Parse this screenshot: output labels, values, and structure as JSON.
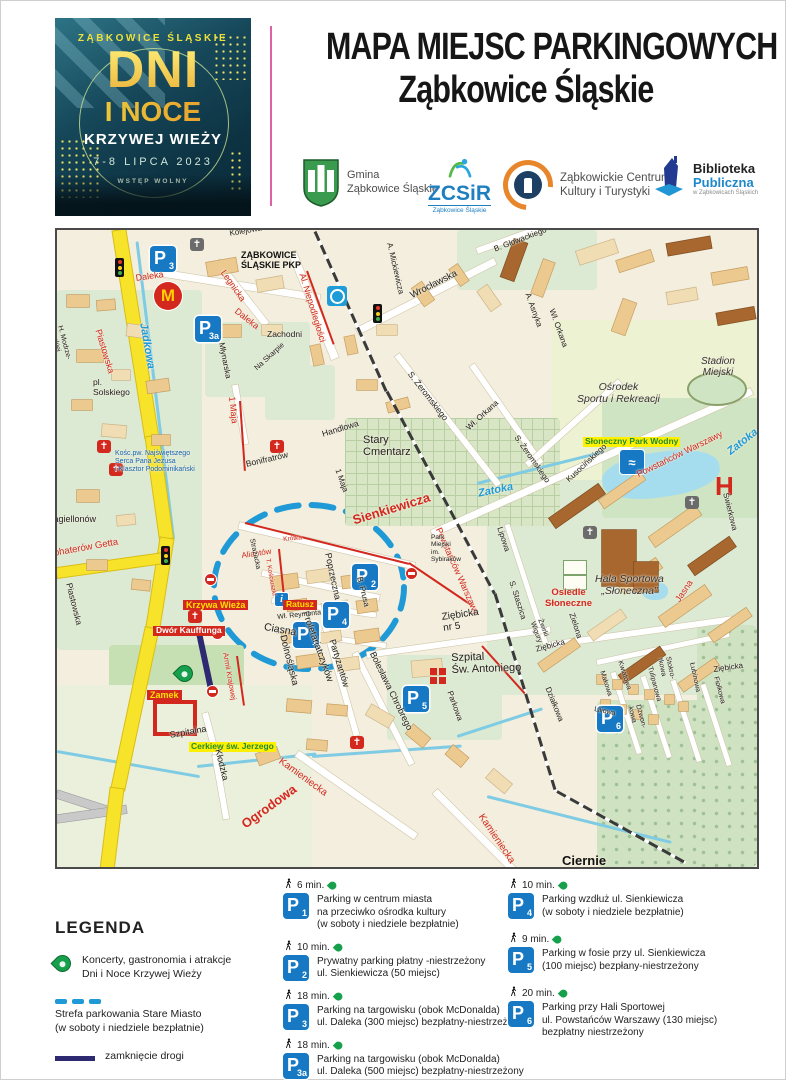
{
  "poster": {
    "city": "ZĄBKOWICE ŚLĄSKIE",
    "line1": "DNI",
    "line2": "I NOCE",
    "line3": "KRZYWEJ WIEŻY",
    "date": "7-8 LIPCA 2023",
    "admission": "WSTĘP WOLNY"
  },
  "header": {
    "title_line1": "MAPA MIEJSC PARKINGOWYCH",
    "title_line2": "Ząbkowice Śląskie"
  },
  "logos": {
    "gmina": "Gmina\nZąbkowice Śląskie",
    "zcsir_acronym": "ZCSiR",
    "zcsir_sub": "Ząbkowice Śląskie",
    "zckit": "Ząbkowickie Centrum\nKultury i Turystyki",
    "biblioteka_line1": "Biblioteka",
    "biblioteka_line2": "Publiczna",
    "biblioteka_sub": "w Ząbkowicach Śląskich"
  },
  "map": {
    "labels": [
      {
        "t": "Kolejowa",
        "x": 172,
        "y": 0,
        "r": -10,
        "s": 8,
        "c": "black"
      },
      {
        "t": "ZĄBKOWICE\nŚLĄSKIE PKP",
        "x": 184,
        "y": 20,
        "r": 0,
        "s": 9,
        "c": "blackb"
      },
      {
        "t": "Legnicka",
        "x": 170,
        "y": 38,
        "r": 55,
        "s": 9,
        "c": "red"
      },
      {
        "t": "Daleka",
        "x": 78,
        "y": 43,
        "r": -8,
        "s": 9,
        "c": "red"
      },
      {
        "t": "Daleka",
        "x": 182,
        "y": 76,
        "r": 38,
        "s": 9,
        "c": "red"
      },
      {
        "t": "Jadkowa",
        "x": 92,
        "y": 92,
        "r": 80,
        "s": 11,
        "c": "blue"
      },
      {
        "t": "Piastowska",
        "x": 46,
        "y": 98,
        "r": 73,
        "s": 9,
        "c": "red"
      },
      {
        "t": "H. Modrze-\njewskiej",
        "x": 6,
        "y": 95,
        "r": 75,
        "s": 7,
        "c": "black"
      },
      {
        "t": "pl.\nSolskiego",
        "x": 36,
        "y": 148,
        "r": 0,
        "s": 8.5,
        "c": "black"
      },
      {
        "t": "Młynarska",
        "x": 168,
        "y": 112,
        "r": 79,
        "s": 8,
        "c": "black"
      },
      {
        "t": "Na Skarpie",
        "x": 196,
        "y": 136,
        "r": -42,
        "s": 7.5,
        "c": "black"
      },
      {
        "t": "Zachodni",
        "x": 210,
        "y": 100,
        "r": 0,
        "s": 8.5,
        "c": "black"
      },
      {
        "t": "Al. Niepodległości",
        "x": 250,
        "y": 42,
        "r": 73,
        "s": 9,
        "c": "red"
      },
      {
        "t": "A. Mickiewicza",
        "x": 336,
        "y": 12,
        "r": 77,
        "s": 8,
        "c": "black"
      },
      {
        "t": "Wrocławska",
        "x": 352,
        "y": 62,
        "r": -27,
        "s": 9.5,
        "c": "black"
      },
      {
        "t": "B. Głowackiego",
        "x": 436,
        "y": 16,
        "r": -21,
        "s": 8,
        "c": "black"
      },
      {
        "t": "S. Żeromskiego",
        "x": 356,
        "y": 140,
        "r": 52,
        "s": 8.5,
        "c": "black"
      },
      {
        "t": "Wł. Orkana",
        "x": 408,
        "y": 196,
        "r": -42,
        "s": 8,
        "c": "black"
      },
      {
        "t": "S. Żeromskiego",
        "x": 462,
        "y": 204,
        "r": 55,
        "s": 8,
        "c": "black"
      },
      {
        "t": "A. Asnyka",
        "x": 474,
        "y": 62,
        "r": 70,
        "s": 8,
        "c": "black"
      },
      {
        "t": "Wł. Orkana",
        "x": 498,
        "y": 78,
        "r": 70,
        "s": 8,
        "c": "black"
      },
      {
        "t": "Stadion\nMiejski",
        "x": 644,
        "y": 126,
        "r": 0,
        "s": 10,
        "c": "it"
      },
      {
        "t": "Ośrodek\nSportu i Rekreacji",
        "x": 520,
        "y": 152,
        "r": 0,
        "s": 10.5,
        "c": "it"
      },
      {
        "t": "Słoneczny Park Wodny",
        "x": 526,
        "y": 207,
        "r": 0,
        "s": 8.5,
        "c": "hl"
      },
      {
        "t": "Zatoka",
        "x": 420,
        "y": 258,
        "r": -12,
        "s": 11,
        "c": "blue"
      },
      {
        "t": "Zatoka",
        "x": 668,
        "y": 218,
        "r": -38,
        "s": 11,
        "c": "blue"
      },
      {
        "t": "Powstańców Warszawy",
        "x": 578,
        "y": 240,
        "r": -26,
        "s": 9,
        "c": "red"
      },
      {
        "t": "Powstańców Warszawy",
        "x": 386,
        "y": 296,
        "r": 66,
        "s": 9,
        "c": "red"
      },
      {
        "t": "Kusocińskiego",
        "x": 508,
        "y": 248,
        "r": -43,
        "s": 8,
        "c": "black"
      },
      {
        "t": "Lipowa",
        "x": 446,
        "y": 296,
        "r": 72,
        "s": 8,
        "c": "black"
      },
      {
        "t": "S. Staszica",
        "x": 458,
        "y": 350,
        "r": 72,
        "s": 8,
        "c": "black"
      },
      {
        "t": "Świerkowa",
        "x": 672,
        "y": 262,
        "r": 76,
        "s": 8,
        "c": "black"
      },
      {
        "t": "Hala Sportowa\n„Słoneczna”",
        "x": 538,
        "y": 344,
        "r": 0,
        "s": 10.5,
        "c": "it"
      },
      {
        "t": "Osiedle\nSłoneczne",
        "x": 488,
        "y": 358,
        "r": 0,
        "s": 9.5,
        "c": "redbold"
      },
      {
        "t": "Jasna",
        "x": 616,
        "y": 368,
        "r": -56,
        "s": 9,
        "c": "red"
      },
      {
        "t": "Zielona",
        "x": 518,
        "y": 382,
        "r": 72,
        "s": 8,
        "c": "black"
      },
      {
        "t": "Żwirki\nWigury",
        "x": 486,
        "y": 388,
        "r": 70,
        "s": 7,
        "c": "black"
      },
      {
        "t": "Ziębicka",
        "x": 478,
        "y": 416,
        "r": -15,
        "s": 8,
        "c": "black"
      },
      {
        "t": "Ziębicka",
        "x": 656,
        "y": 436,
        "r": -8,
        "s": 8,
        "c": "black"
      },
      {
        "t": "Ziębicka\nnr 5",
        "x": 384,
        "y": 382,
        "r": -8,
        "s": 10,
        "c": "black"
      },
      {
        "t": "Szpital\nŚw. Antoniego",
        "x": 394,
        "y": 422,
        "r": -2,
        "s": 11,
        "c": "black"
      },
      {
        "t": "Parkowa",
        "x": 396,
        "y": 460,
        "r": 70,
        "s": 8,
        "c": "black"
      },
      {
        "t": "Bolesława Chrobrego",
        "x": 320,
        "y": 420,
        "r": 64,
        "s": 9,
        "c": "black"
      },
      {
        "t": "Działkowa",
        "x": 494,
        "y": 456,
        "r": 68,
        "s": 8,
        "c": "black"
      },
      {
        "t": "Partyzantów",
        "x": 280,
        "y": 408,
        "r": 73,
        "s": 9,
        "c": "black"
      },
      {
        "t": "B. Prusa",
        "x": 306,
        "y": 346,
        "r": 76,
        "s": 8,
        "c": "black"
      },
      {
        "t": "Poprzeczna",
        "x": 276,
        "y": 322,
        "r": 78,
        "s": 9,
        "c": "black"
      },
      {
        "t": "Proletariatczyków",
        "x": 252,
        "y": 380,
        "r": 70,
        "s": 9.5,
        "c": "black"
      },
      {
        "t": "Dolnośląska",
        "x": 230,
        "y": 404,
        "r": 76,
        "s": 9.5,
        "c": "black"
      },
      {
        "t": "Ciasna",
        "x": 208,
        "y": 392,
        "r": 10,
        "s": 10.5,
        "c": "black"
      },
      {
        "t": "Wł. Reymonta",
        "x": 220,
        "y": 384,
        "r": -6,
        "s": 7,
        "c": "black"
      },
      {
        "t": "Krótka",
        "x": 226,
        "y": 306,
        "r": -5,
        "s": 6.5,
        "c": "red"
      },
      {
        "t": "Aliantów",
        "x": 184,
        "y": 322,
        "r": -8,
        "s": 8,
        "c": "red"
      },
      {
        "t": "T. Kościuszki",
        "x": 214,
        "y": 328,
        "r": 80,
        "s": 6.5,
        "c": "red"
      },
      {
        "t": "Strażacka",
        "x": 198,
        "y": 308,
        "r": 78,
        "s": 7,
        "c": "black"
      },
      {
        "t": "Armii Krajowej",
        "x": 172,
        "y": 422,
        "r": 80,
        "s": 7.5,
        "c": "red"
      },
      {
        "t": "Sienkiewicza",
        "x": 294,
        "y": 284,
        "r": -17,
        "s": 13,
        "c": "redbig"
      },
      {
        "t": "1 Maja",
        "x": 180,
        "y": 166,
        "r": 84,
        "s": 9,
        "c": "red"
      },
      {
        "t": "1 Maja",
        "x": 284,
        "y": 238,
        "r": 70,
        "s": 8,
        "c": "black"
      },
      {
        "t": "Handlowa",
        "x": 264,
        "y": 200,
        "r": -17,
        "s": 8.5,
        "c": "black"
      },
      {
        "t": "Bonifratrów",
        "x": 188,
        "y": 230,
        "r": -13,
        "s": 8.5,
        "c": "black"
      },
      {
        "t": "Stary\nCmentarz",
        "x": 306,
        "y": 204,
        "r": 0,
        "s": 11,
        "c": "black"
      },
      {
        "t": "Kośc.pw. Najświętszego\nSerca Pana Jezusa\ni Klasztor Podominikański",
        "x": 58,
        "y": 220,
        "r": 0,
        "s": 7,
        "c": "blue2"
      },
      {
        "t": "Jagiellonów",
        "x": -8,
        "y": 284,
        "r": 0,
        "s": 9,
        "c": "black"
      },
      {
        "t": "Bohaterów Getta",
        "x": -10,
        "y": 320,
        "r": -10,
        "s": 9.5,
        "c": "red"
      },
      {
        "t": "Piastowska",
        "x": 16,
        "y": 352,
        "r": 76,
        "s": 8.5,
        "c": "black"
      },
      {
        "t": "Krzywa Wieża",
        "x": 126,
        "y": 370,
        "r": 0,
        "s": 9,
        "c": "redbg-y"
      },
      {
        "t": "Dwór Kauffunga",
        "x": 96,
        "y": 396,
        "r": 0,
        "s": 8.5,
        "c": "redbg-w"
      },
      {
        "t": "Ratusz",
        "x": 226,
        "y": 370,
        "r": 0,
        "s": 8.5,
        "c": "redbg-y"
      },
      {
        "t": "Zamek",
        "x": 90,
        "y": 460,
        "r": 0,
        "s": 9,
        "c": "redbg-y"
      },
      {
        "t": "Szpitalna",
        "x": 112,
        "y": 500,
        "r": -10,
        "s": 9,
        "c": "black"
      },
      {
        "t": "Cerkiew św. Jerzego",
        "x": 132,
        "y": 512,
        "r": 0,
        "s": 8.5,
        "c": "hl"
      },
      {
        "t": "Kłodzka",
        "x": 166,
        "y": 518,
        "r": 76,
        "s": 9,
        "c": "black"
      },
      {
        "t": "Kamieniecka",
        "x": 226,
        "y": 526,
        "r": 36,
        "s": 10,
        "c": "red"
      },
      {
        "t": "Kamieniecka",
        "x": 428,
        "y": 582,
        "r": 56,
        "s": 10,
        "c": "red"
      },
      {
        "t": "Ogrodowa",
        "x": 182,
        "y": 590,
        "r": -36,
        "s": 13,
        "c": "redbig"
      },
      {
        "t": "Park\nMiejski\nim.\nSybiraków",
        "x": 374,
        "y": 304,
        "r": 0,
        "s": 6.5,
        "c": "black"
      },
      {
        "t": "Kwiatowa",
        "x": 566,
        "y": 430,
        "r": 72,
        "s": 7,
        "c": "black"
      },
      {
        "t": "Makowa",
        "x": 548,
        "y": 440,
        "r": 72,
        "s": 7,
        "c": "black"
      },
      {
        "t": "Liliowa",
        "x": 538,
        "y": 476,
        "r": 12,
        "s": 7,
        "c": "black"
      },
      {
        "t": "Tulipanowa",
        "x": 596,
        "y": 436,
        "r": 75,
        "s": 7,
        "c": "black"
      },
      {
        "t": "Dzwon-\nkowa",
        "x": 584,
        "y": 474,
        "r": 75,
        "s": 7,
        "c": "black"
      },
      {
        "t": "Stokro-\ntkowa",
        "x": 614,
        "y": 426,
        "r": 78,
        "s": 7,
        "c": "black"
      },
      {
        "t": "Łubinowa",
        "x": 638,
        "y": 432,
        "r": 78,
        "s": 7,
        "c": "black"
      },
      {
        "t": "Fiołkowa",
        "x": 662,
        "y": 446,
        "r": 75,
        "s": 7,
        "c": "black"
      },
      {
        "t": "Ciernie",
        "x": 505,
        "y": 624,
        "r": 0,
        "s": 13,
        "c": "blackb"
      }
    ],
    "markers": [
      {
        "type": "parking",
        "n": "3",
        "x": 93,
        "y": 16
      },
      {
        "type": "parking",
        "n": "3a",
        "x": 138,
        "y": 60
      },
      {
        "type": "parking",
        "n": "1",
        "x": 236,
        "y": 340
      },
      {
        "type": "parking",
        "n": "2",
        "x": 295,
        "y": 256
      },
      {
        "type": "parking",
        "n": "4",
        "x": 266,
        "y": 268
      },
      {
        "type": "parking",
        "n": "5",
        "x": 346,
        "y": 326
      },
      {
        "type": "parking",
        "n": "6",
        "x": 540,
        "y": 320
      },
      {
        "type": "mcdonalds",
        "x": 97,
        "y": 52
      },
      {
        "type": "traffic-light",
        "x": 58,
        "y": 28
      },
      {
        "type": "traffic-light",
        "x": 104,
        "y": 316
      },
      {
        "type": "traffic-light",
        "x": 316,
        "y": 74
      },
      {
        "type": "church-red",
        "x": 213,
        "y": 210
      },
      {
        "type": "church-red",
        "x": 40,
        "y": 210
      },
      {
        "type": "church-red",
        "x": 52,
        "y": 233
      },
      {
        "type": "church-red",
        "x": 131,
        "y": 380
      },
      {
        "type": "church-red",
        "x": 293,
        "y": 506
      },
      {
        "type": "church-gray",
        "x": 133,
        "y": 8
      },
      {
        "type": "church-gray",
        "x": 526,
        "y": 296
      },
      {
        "type": "church-gray",
        "x": 628,
        "y": 266
      },
      {
        "type": "no-entry",
        "x": 148,
        "y": 344
      },
      {
        "type": "no-entry",
        "x": 155,
        "y": 398
      },
      {
        "type": "no-entry",
        "x": 150,
        "y": 456
      },
      {
        "type": "no-entry",
        "x": 349,
        "y": 338
      },
      {
        "type": "pin",
        "x": 120,
        "y": 436
      },
      {
        "type": "pool",
        "x": 563,
        "y": 220
      },
      {
        "type": "hospital",
        "x": 658,
        "y": 243
      },
      {
        "type": "medical-cross",
        "x": 373,
        "y": 438
      },
      {
        "type": "info",
        "x": 218,
        "y": 363
      },
      {
        "type": "transport",
        "x": 270,
        "y": 56
      },
      {
        "type": "tennis-court",
        "x": 506,
        "y": 330
      },
      {
        "type": "stadium",
        "x": 630,
        "y": 142
      },
      {
        "type": "castle",
        "x": 96,
        "y": 470
      }
    ]
  },
  "legend": {
    "title": "LEGENDA",
    "pin_label": "Koncerty, gastronomia i atrakcje\nDni i Noce Krzywej Wieży",
    "zone_label": "Strefa parkowania Stare Miasto\n(w soboty i niedziele bezpłatnie)",
    "closed_label": "zamknięcie drogi"
  },
  "parking_list": {
    "left": [
      {
        "time": "6 min.",
        "badge": "1",
        "desc": "Parking w centrum miasta\nna przeciwko ośrodka kultury\n(w soboty i niedziele bezpłatnie)"
      },
      {
        "time": "10 min.",
        "badge": "2",
        "desc": "Prywatny parking płatny -niestrzeżony\nul. Sienkiewicza (50 miejsc)"
      },
      {
        "time": "18 min.",
        "badge": "3",
        "desc": "Parking na targowisku (obok McDonalda)\nul. Daleka (300 miejsc) bezpłatny-niestrzeżony"
      },
      {
        "time": "18 min.",
        "badge": "3a",
        "desc": "Parking na targowisku (obok McDonalda)\nul. Daleka (500 miejsc) bezpłatny-niestrzeżony"
      }
    ],
    "right": [
      {
        "time": "10 min.",
        "badge": "4",
        "desc": "Parking wzdłuż ul. Sienkiewicza\n(w soboty i niedziele bezpłatnie)"
      },
      {
        "time": "9 min.",
        "badge": "5",
        "desc": "Parking w fosie przy ul. Sienkiewicza\n(100 miejsc) bezpłany-niestrzeżony"
      },
      {
        "time": "20 min.",
        "badge": "6",
        "desc": "Parking przy Hali Sportowej\nul. Powstańców Warszawy (130 miejsc)\nbezpłatny niestrzeżony"
      }
    ]
  }
}
